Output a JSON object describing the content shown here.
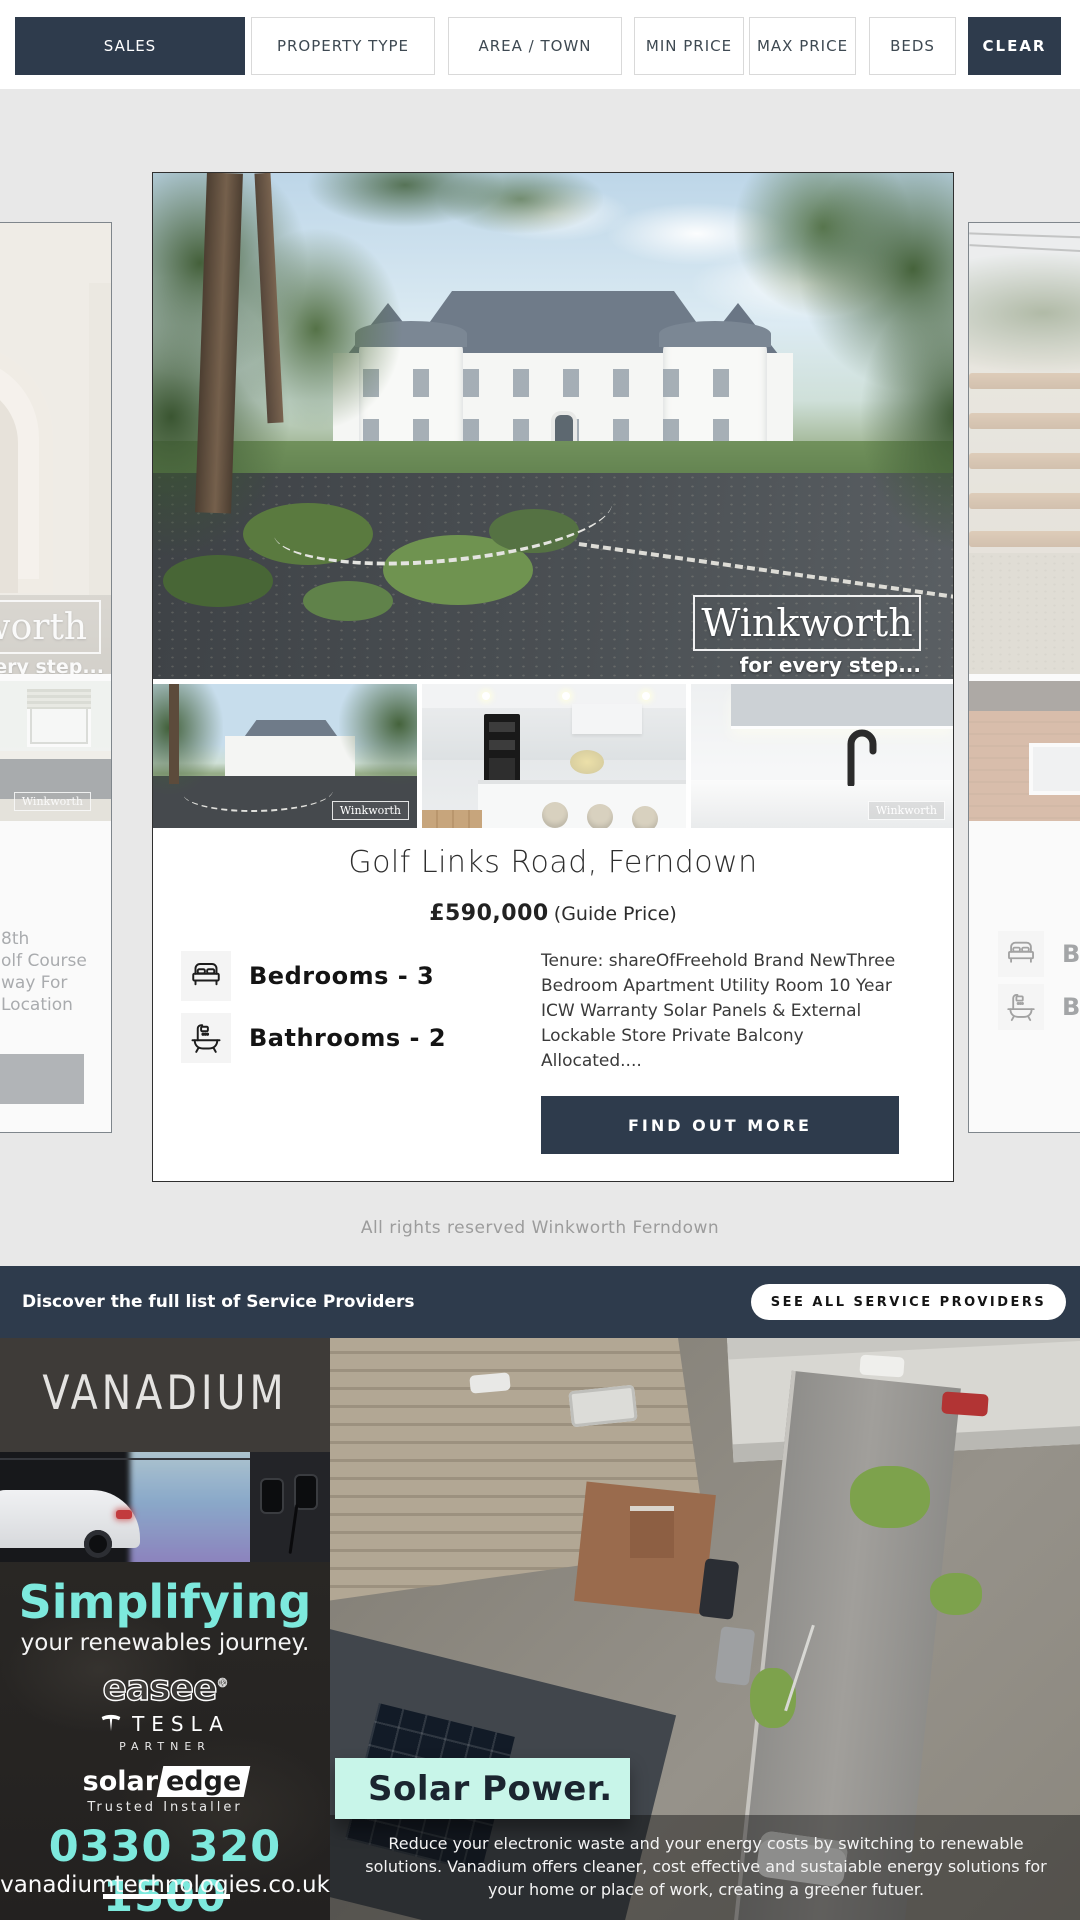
{
  "filter_bar": {
    "buttons": [
      {
        "label": "SALES"
      },
      {
        "label": "PROPERTY TYPE"
      },
      {
        "label": "AREA / TOWN"
      },
      {
        "label": "MIN PRICE"
      },
      {
        "label": "MAX PRICE"
      },
      {
        "label": "BEDS"
      },
      {
        "label": "CLEAR"
      }
    ]
  },
  "listing": {
    "title": "Golf Links Road, Ferndown",
    "price": "£590,000",
    "price_qualifier": "(Guide Price)",
    "bedrooms": "Bedrooms - 3",
    "bathrooms": "Bathrooms - 2",
    "description": "Tenure: shareOfFreehold Brand NewThree Bedroom Apartment Utility Room 10 Year ICW Warranty Solar Panels & External Lockable Store Private Balcony Allocated....",
    "cta": "FIND OUT MORE",
    "watermark": "Winkworth",
    "watermark_tagline": "for every step...",
    "thumb_watermark": "Winkworth"
  },
  "left_card": {
    "description_fragments": [
      "8th",
      "olf Course",
      "way For",
      "Location"
    ],
    "watermark": "Winkworth",
    "watermark_tagline": "for every step...",
    "thumb_watermark": "Winkworth"
  },
  "right_card": {
    "bedrooms_fragment": "Be",
    "bathrooms_fragment": "Ba"
  },
  "copyright": "All rights reserved Winkworth Ferndown",
  "service_bar": {
    "heading": "Discover the full list of Service Providers",
    "button": "SEE ALL SERVICE PROVIDERS"
  },
  "ad": {
    "brand": "VANADIUM",
    "headline": "Simplifying",
    "subheadline": "your renewables journey.",
    "partner_easee": "easee",
    "partner_easee_reg": "®",
    "partner_tesla": "TESLA",
    "partner_tesla_sub": "PARTNER",
    "partner_solaredge_a": "solar",
    "partner_solaredge_b": "edge",
    "partner_solaredge_sub": "Trusted Installer",
    "phone": "0330 320 1500",
    "website": "vanadiumtechnologies.co.uk",
    "banner_title": "Solar Power.",
    "body": "Reduce your electronic waste and your energy costs by switching to renewable solutions. Vanadium offers cleaner, cost effective and sustaiable energy solutions for your home or place of work, creating a greener futuer."
  },
  "colors": {
    "navy": "#2e3b4c",
    "accent_cyan": "#7de9dd",
    "mint": "#c8f5e9",
    "page_bg": "#e8e8e8"
  }
}
